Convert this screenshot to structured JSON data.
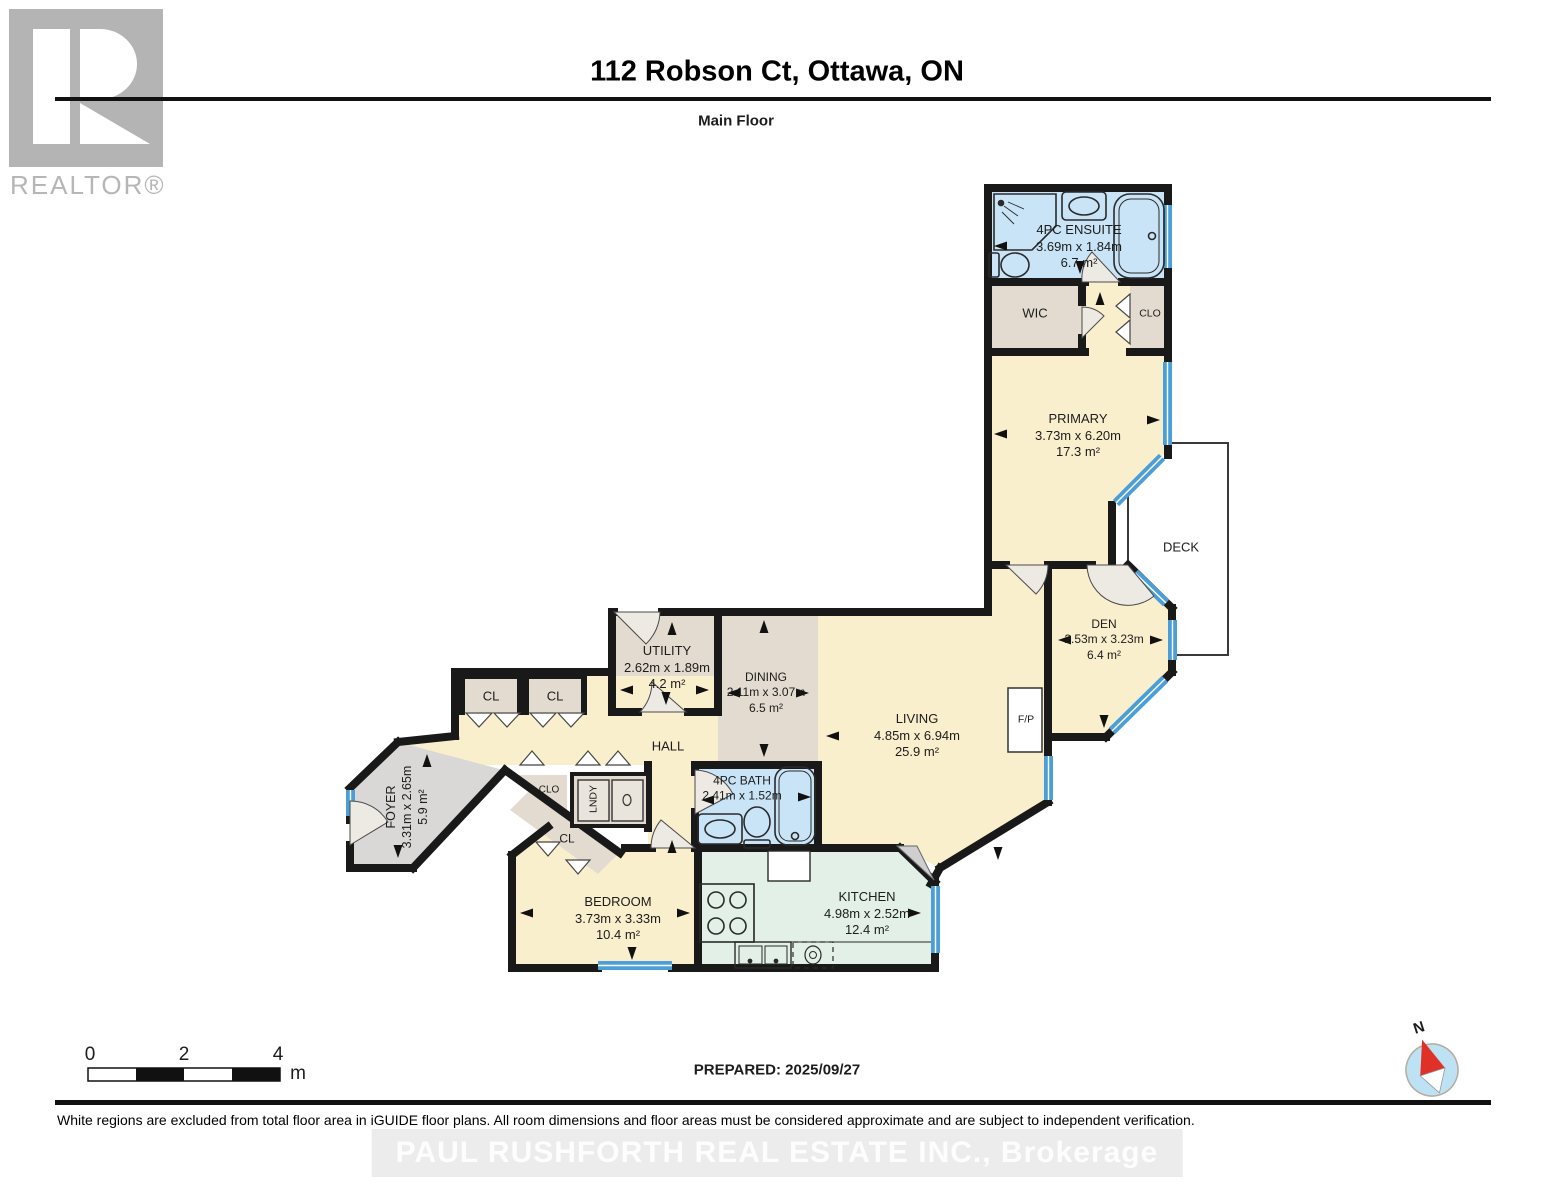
{
  "header": {
    "title": "112 Robson Ct, Ottawa, ON",
    "subtitle": "Main Floor"
  },
  "branding": {
    "logo_text": "REALTOR®",
    "watermark": "PAUL RUSHFORTH REAL ESTATE INC., Brokerage"
  },
  "rooms": {
    "ensuite": {
      "name": "4PC ENSUITE",
      "dims": "3.69m x 1.84m",
      "area": "6.7 m²"
    },
    "wic": {
      "name": "WIC"
    },
    "clo_primary": {
      "name": "CLO"
    },
    "primary": {
      "name": "PRIMARY",
      "dims": "3.73m x 6.20m",
      "area": "17.3 m²"
    },
    "deck": {
      "name": "DECK"
    },
    "den": {
      "name": "DEN",
      "dims": "2.53m x 3.23m",
      "area": "6.4 m²"
    },
    "living": {
      "name": "LIVING",
      "dims": "4.85m x 6.94m",
      "area": "25.9 m²"
    },
    "fireplace": {
      "name": "F/P"
    },
    "dining": {
      "name": "DINING",
      "dims": "2.11m x 3.07m",
      "area": "6.5 m²"
    },
    "utility": {
      "name": "UTILITY",
      "dims": "2.62m x 1.89m",
      "area": "4.2 m²"
    },
    "hall": {
      "name": "HALL"
    },
    "cl_hall_1": {
      "name": "CL"
    },
    "cl_hall_2": {
      "name": "CL"
    },
    "foyer": {
      "name": "FOYER",
      "dims": "3.31m x 2.65m",
      "area": "5.9 m²"
    },
    "clo_hall": {
      "name": "CLO"
    },
    "laundry": {
      "name": "LNDY"
    },
    "cl_bedroom": {
      "name": "CL"
    },
    "bath": {
      "name": "4PC BATH",
      "dims": "2.41m x 1.52m"
    },
    "bedroom": {
      "name": "BEDROOM",
      "dims": "3.73m x 3.33m",
      "area": "10.4 m²"
    },
    "kitchen": {
      "name": "KITCHEN",
      "dims": "4.98m x 2.52m",
      "area": "12.4 m²"
    }
  },
  "footer": {
    "scale": {
      "t0": "0",
      "t2": "2",
      "t4": "4",
      "unit": "m"
    },
    "prepared": "PREPARED: 2025/09/27",
    "compass_n": "N",
    "disclaimer": "White regions are excluded from total floor area in iGUIDE floor plans. All room dimensions and floor areas must be considered approximate and are subject to independent verification."
  },
  "colors": {
    "room_yellow": "#FAEFCD",
    "room_tan": "#E3DBCF",
    "room_blue": "#C8E4F6",
    "room_mint": "#E3F0E8",
    "room_gray": "#D9D8D6",
    "wall": "#191919",
    "window": "#4C9FD6",
    "compass_red": "#E03128"
  }
}
